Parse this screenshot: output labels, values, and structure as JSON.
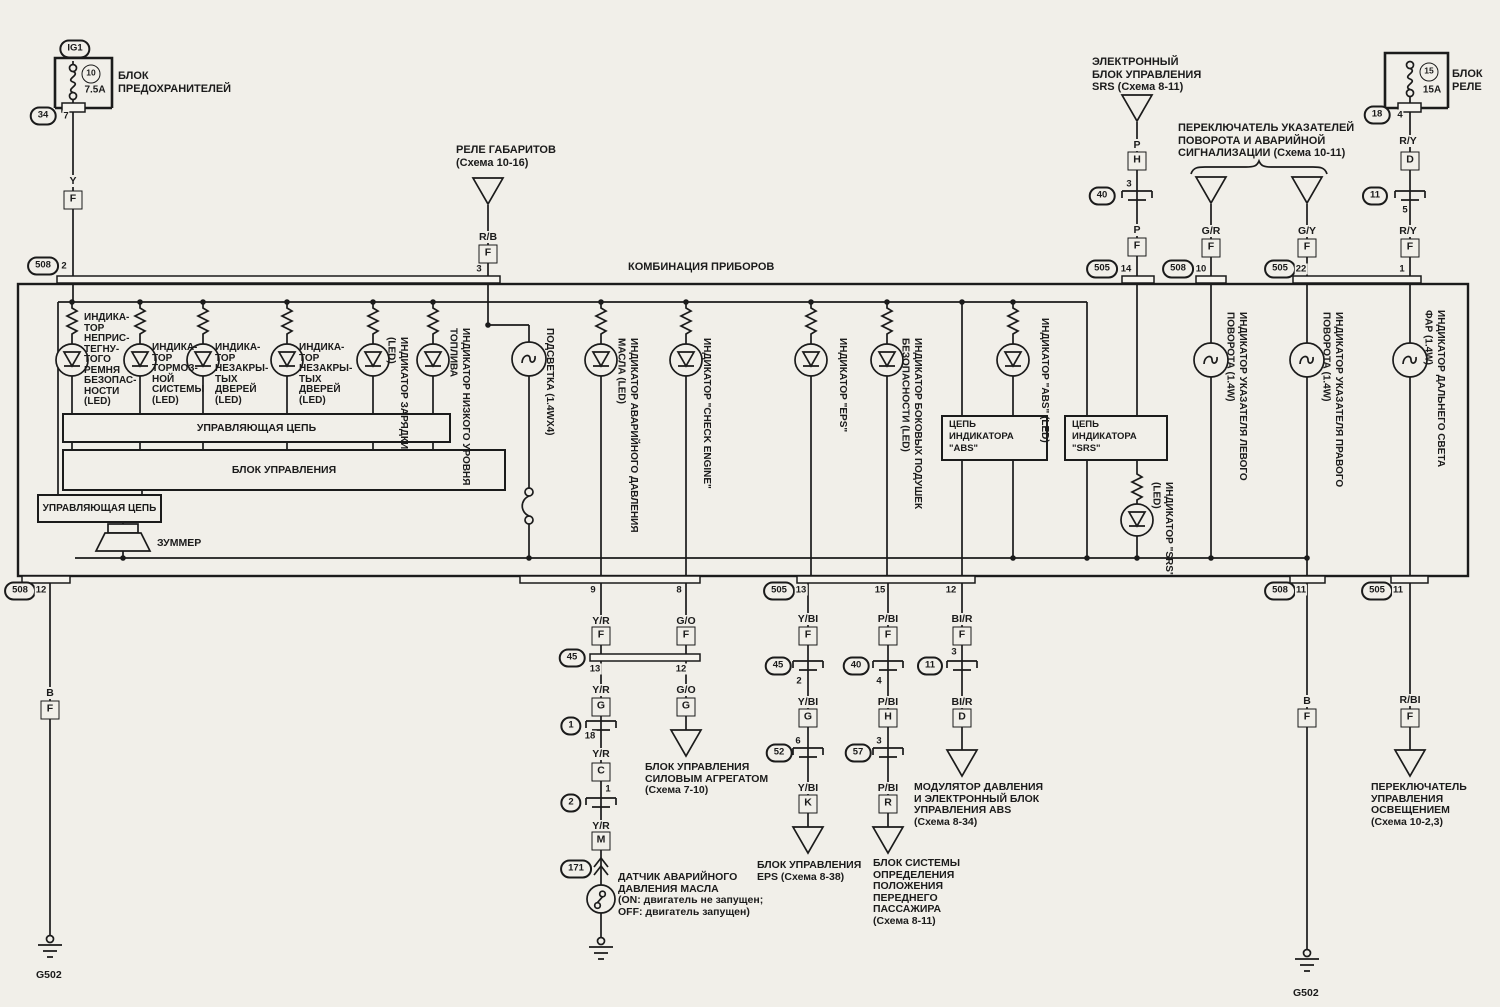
{
  "page": {
    "background": "#f1efe9",
    "ink": "#1b1b1b"
  },
  "cluster": {
    "title": "КОМБИНАЦИЯ ПРИБОРОВ",
    "ctrl_top": "УПРАВЛЯЮЩАЯ ЦЕПЬ",
    "ctrl_main": "БЛОК УПРАВЛЕНИЯ",
    "ctrl_left": "УПРАВЛЯЮЩАЯ ЦЕПЬ",
    "buzzer": "ЗУММЕР",
    "abs_box": "ЦЕПЬ\nИНДИКАТОРА\n\"ABS\"",
    "srs_box": "ЦЕПЬ\nИНДИКАТОРА\n\"SRS\"",
    "ind": [
      "ИНДИКА-\nТОР\nНЕПРИС-\nТЕГНУ-\nТОГО\nРЕМНЯ\nБЕЗОПАС-\nНОСТИ\n(LED)",
      "ИНДИКА-\nТОР\nТОРМОЗ-\nНОЙ\nСИСТЕМЫ\n(LED)",
      "ИНДИКА-\nТОР\nНЕЗАКРЫ-\nТЫХ\nДВЕРЕЙ\n(LED)",
      "ИНДИКА-\nТОР\nНЕЗАКРЫ-\nТЫХ\nДВЕРЕЙ\n(LED)",
      "ИНДИКАТОР ЗАРЯДКИ (LED)",
      "ИНДИКАТОР НИЗКОГО УРОВНЯ ТОПЛИВА",
      "ПОДСВЕТКА (1.4WX4)",
      "ИНДИКАТОР АВАРИЙНОГО ДАВЛЕНИЯ МАСЛА (LED)",
      "ИНДИКАТОР \"CHECK ENGINE\"",
      "ИНДИКАТОР \"EPS\"",
      "ИНДИКАТОР БОКОВЫХ ПОДУШЕК БЕЗОПАСНОСТИ (LED)",
      "ИНДИКАТОР \"ABS\" (LED)",
      "ИНДИКАТОР \"SRS\" (LED)",
      "ИНДИКАТОР УКАЗАТЕЛЯ ЛЕВОГО ПОВОРОТА (1.4W)",
      "ИНДИКАТОР УКАЗАТЕЛЯ ПРАВОГО ПОВОРОТА (1.4W)",
      "ИНДИКАТОР ДАЛЬНЕГО СВЕТА ФАР (1.4W)"
    ]
  },
  "fusebox": {
    "conn": "IG1",
    "num": "10",
    "amp": "7.5A",
    "name": "БЛОК\nПРЕДОХРАНИТЕЛЕЙ",
    "oval": "34",
    "pin": "7",
    "wire": "Y",
    "lb": "F",
    "oval2": "508",
    "pin2": "2"
  },
  "gab": {
    "name": "РЕЛЕ ГАБАРИТОВ\n(Схема 10-16)",
    "wire": "R/B",
    "lb": "F",
    "pin": "3"
  },
  "srs": {
    "name": "ЭЛЕКТРОННЫЙ\nБЛОК УПРАВЛЕНИЯ\nSRS (Схема 8-11)",
    "w1": "P",
    "lb1": "H",
    "p1": "3",
    "oval": "40",
    "w2": "P",
    "lb2": "F",
    "oval2": "505",
    "p2": "14"
  },
  "turn": {
    "name": "ПЕРЕКЛЮЧАТЕЛЬ УКАЗАТЕЛЕЙ\nПОВОРОТА И АВАРИЙНОЙ\nСИГНАЛИЗАЦИИ (Схема 10-11)",
    "lw": "G/R",
    "llb": "F",
    "loval": "508",
    "lpin": "10",
    "rw": "G/Y",
    "rlb": "F",
    "roval": "505",
    "rpin": "22"
  },
  "relay": {
    "num": "15",
    "amp": "15A",
    "name": "БЛОК\nРЕЛЕ",
    "oval": "18",
    "pin": "4",
    "w1": "R/Y",
    "lb1": "D",
    "oval2": "11",
    "p2": "5",
    "w2": "R/Y",
    "lb2": "F",
    "p3": "1"
  },
  "bot": {
    "g1": {
      "oval": "508",
      "pin": "12",
      "w": "B",
      "lb": "F",
      "gnd": "G502"
    },
    "oil": {
      "pin": "9",
      "w1": "Y/R",
      "lb1": "F",
      "oval": "45",
      "pl": "13",
      "pr": "12",
      "w2": "Y/R",
      "lb2": "G",
      "oval2": "1",
      "p2": "18",
      "w3": "Y/R",
      "lb3": "C",
      "p3": "1",
      "oval3": "2",
      "w4": "Y/R",
      "lb4": "M",
      "oval4": "171",
      "name": "ДАТЧИК АВАРИЙНОГО\nДАВЛЕНИЯ МАСЛА\n(ON: двигатель не запущен;\nOFF: двигатель запущен)"
    },
    "pcm": {
      "pin": "8",
      "w1": "G/O",
      "lb1": "F",
      "w2": "G/O",
      "lb2": "G",
      "name": "БЛОК УПРАВЛЕНИЯ\nСИЛОВЫМ АГРЕГАТОМ\n(Схема 7-10)"
    },
    "eps": {
      "oval0": "505",
      "pin": "13",
      "w1": "Y/BI",
      "lb1": "F",
      "oval": "45",
      "p1": "2",
      "w2": "Y/BI",
      "lb2": "G",
      "p2": "6",
      "oval2": "52",
      "w3": "Y/BI",
      "lb3": "K",
      "name": "БЛОК УПРАВЛЕНИЯ\nEPS (Схема 8-38)"
    },
    "pas": {
      "pin": "15",
      "w1": "P/BI",
      "lb1": "F",
      "oval": "40",
      "p1": "4",
      "w2": "P/BI",
      "lb2": "H",
      "p2": "3",
      "oval2": "57",
      "w3": "P/BI",
      "lb3": "R",
      "name": "БЛОК СИСТЕМЫ\nОПРЕДЕЛЕНИЯ\nПОЛОЖЕНИЯ\nПЕРЕДНЕГО\nПАССАЖИРА\n(Схема 8-11)"
    },
    "abs": {
      "pin": "12",
      "w1": "BI/R",
      "lb1": "F",
      "p1": "3",
      "oval": "11",
      "w2": "BI/R",
      "lb2": "D",
      "name": "МОДУЛЯТОР ДАВЛЕНИЯ\nИ ЭЛЕКТРОННЫЙ БЛОК\nУПРАВЛЕНИЯ ABS\n(Схема 8-34)"
    },
    "g2": {
      "oval": "508",
      "pin": "11",
      "w": "B",
      "lb": "F",
      "gnd": "G502"
    },
    "lsw": {
      "oval": "505",
      "pin": "11",
      "w": "R/BI",
      "lb": "F",
      "name": "ПЕРЕКЛЮЧАТЕЛЬ\nУПРАВЛЕНИЯ\nОСВЕЩЕНИЕМ\n(Схема 10-2,3)"
    }
  }
}
